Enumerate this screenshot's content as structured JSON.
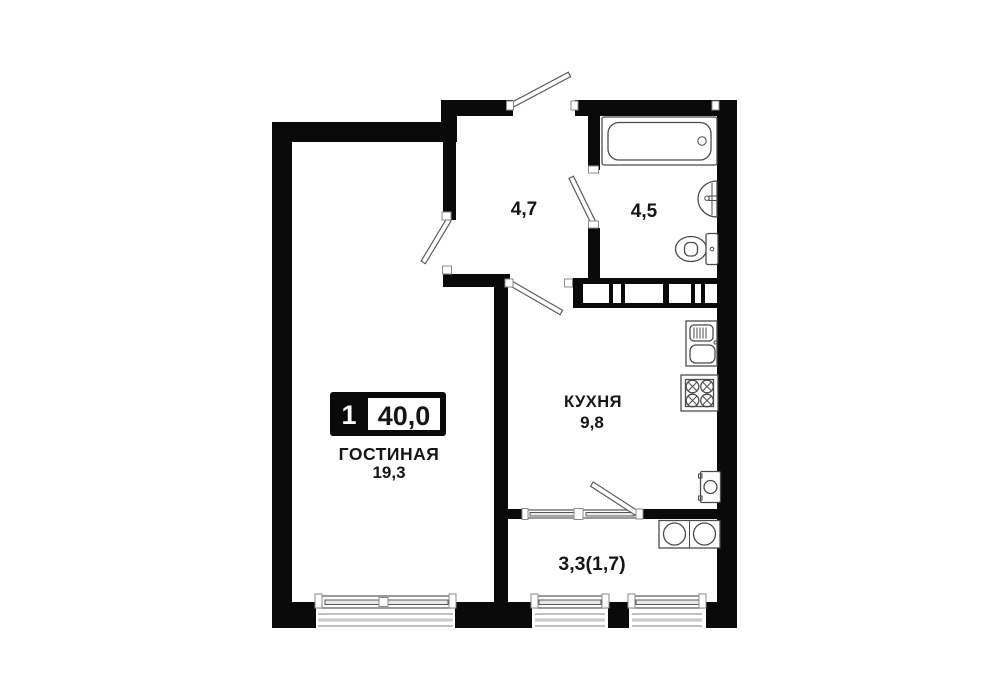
{
  "plan": {
    "badge": {
      "room_count": "1",
      "total_area": "40,0"
    },
    "living": {
      "name": "ГОСТИНАЯ",
      "area": "19,3"
    },
    "kitchen": {
      "name": "КУХНЯ",
      "area": "9,8"
    },
    "hallway": {
      "area": "4,7"
    },
    "bathroom": {
      "area": "4,5"
    },
    "balcony": {
      "area": "3,3(1,7)"
    },
    "fixtures": [
      "bathtub",
      "washbasin",
      "toilet",
      "vent-shaft",
      "kitchen-sink",
      "stove",
      "washing-machine",
      "washer-dryer-pair",
      "window",
      "door-leaf"
    ],
    "colors": {
      "wall": "#0a0a0a",
      "background": "#ffffff",
      "fixture_line": "#4b4b4b"
    }
  }
}
